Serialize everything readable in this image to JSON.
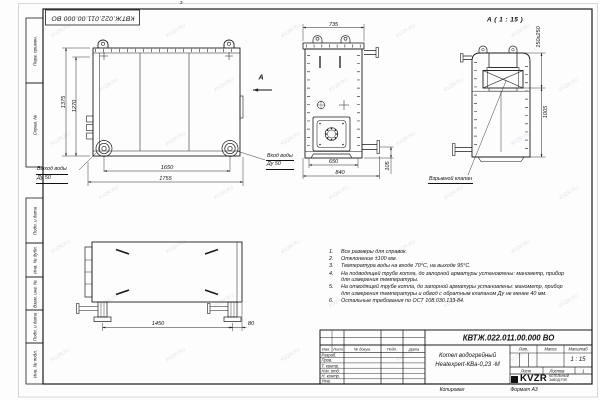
{
  "sheet": {
    "zone_mark": "3",
    "doc_number_rotated": "КВТЖ.022.011.00.000 ВО",
    "copied_label": "Копировал",
    "format_label": "Формат А3"
  },
  "frame_fields": {
    "perv_primen": "Перв. примен.",
    "sprav_no": "Справ. №",
    "podp_data_upper": "Подп. и дата",
    "inv_dubl": "Инв. № дубл.",
    "vzam_inv": "Взам. инв. №",
    "podp_data_lower": "Подп. и дата",
    "inv_podl": "Инв. № подл."
  },
  "front_view": {
    "dim_height_outer": "1375",
    "dim_height_inner": "1270",
    "dim_width_inner": "1650",
    "dim_width_outer": "1755",
    "outlet_line1": "Выход воды",
    "outlet_line2": "Ду 50",
    "inlet_line1": "Вход воды",
    "inlet_line2": "Ду 50",
    "section_arrow": "А"
  },
  "side_view": {
    "dim_width_top": "735",
    "dim_width_inner": "650",
    "dim_width_outer": "840",
    "dim_pipe_height": "105"
  },
  "detail_view": {
    "title": "А ( 1 : 15 )",
    "dim_valve": "150х250",
    "dim_height": "1005",
    "valve_label": "Взрывной клапан"
  },
  "top_view": {
    "dim_length": "1450",
    "dim_back": "80"
  },
  "notes": {
    "items": [
      {
        "num": "1.",
        "text": "Все размеры для справок."
      },
      {
        "num": "2.",
        "text": "Отклонение ±100 мм."
      },
      {
        "num": "3.",
        "text": "Температура воды на входе 70°С, на выходе 95°С."
      },
      {
        "num": "4.",
        "text": "На подводящей трубе котла, до запорной арматуры установлены: манометр, прибор для измерения температуры."
      },
      {
        "num": "5.",
        "text": "На отводящей трубе котла, до запорной арматуры установлены: манометр, прибор для измерения температуры и обвод с обратным клапаном Ду не менее 40 мм."
      },
      {
        "num": "6.",
        "text": "Остальные требования по ОСТ 108.030.133-84."
      }
    ]
  },
  "title_block": {
    "doc_number": "КВТЖ.022.011.00.000 ВО",
    "product_name_line1": "Котел водогрейный",
    "product_name_line2": "Heatexpert-КВа-0,23 -М",
    "col_izm": "Изм.",
    "col_list": "Лист",
    "col_docum": "№ докум.",
    "col_podp": "Подп.",
    "col_data": "Дата",
    "row_razrab": "Разраб.",
    "row_prov": "Пров.",
    "row_tkontr": "Т. контр.",
    "row_nachotd": "Нач. отд.",
    "row_nkontr": "Н. контр.",
    "row_utv": "Утв.",
    "lit_label": "Лит.",
    "massa_label": "Масса",
    "masshtab_label": "Масштаб",
    "scale_value": "1 : 15",
    "list_label": "Лист",
    "listov_label": "Листов",
    "listov_value": "1",
    "logo_text": "KVZR",
    "logo_caption_line1": "КОТЕЛЬНЫЙ",
    "logo_caption_line2": "ЗАВОД РЭП"
  },
  "watermark": {
    "text": "KVZR.RU"
  }
}
